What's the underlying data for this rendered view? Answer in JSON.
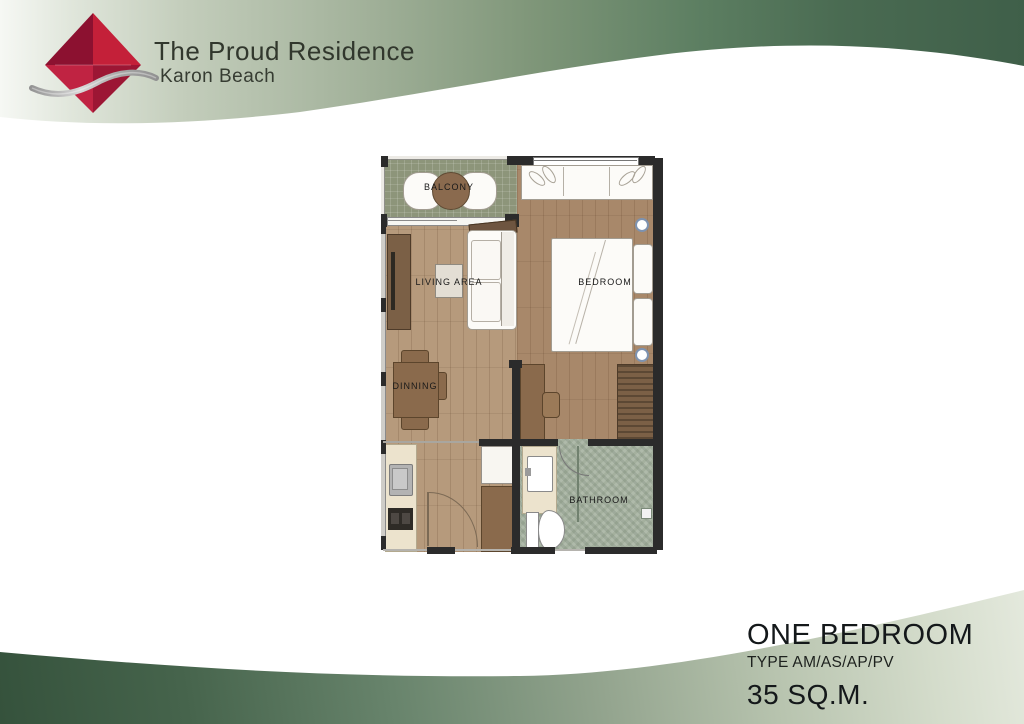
{
  "brand": {
    "title": "The Proud Residence",
    "subtitle": "Karon Beach",
    "logo_icon": "red-diamond-with-silver-wave"
  },
  "plan": {
    "rooms": {
      "balcony": "BALCONY",
      "living": "LIVING AREA",
      "bedroom": "BEDROOM",
      "dining": "DINNING",
      "bathroom": "BATHROOM"
    }
  },
  "footer": {
    "unit_name": "ONE BEDROOM",
    "unit_type": "TYPE AM/AS/AP/PV",
    "unit_area": "35 SQ.M."
  },
  "colors": {
    "brand_red": "#c42039",
    "band_green_dark": "#40604a",
    "band_green_light": "#dfe5d9",
    "wood_floor": "#b69a7c",
    "bedroom_floor": "#a8886a",
    "balcony_floor": "#8d957a",
    "bathroom_tile": "#a4b09e",
    "wall": "#2b2b2b"
  }
}
